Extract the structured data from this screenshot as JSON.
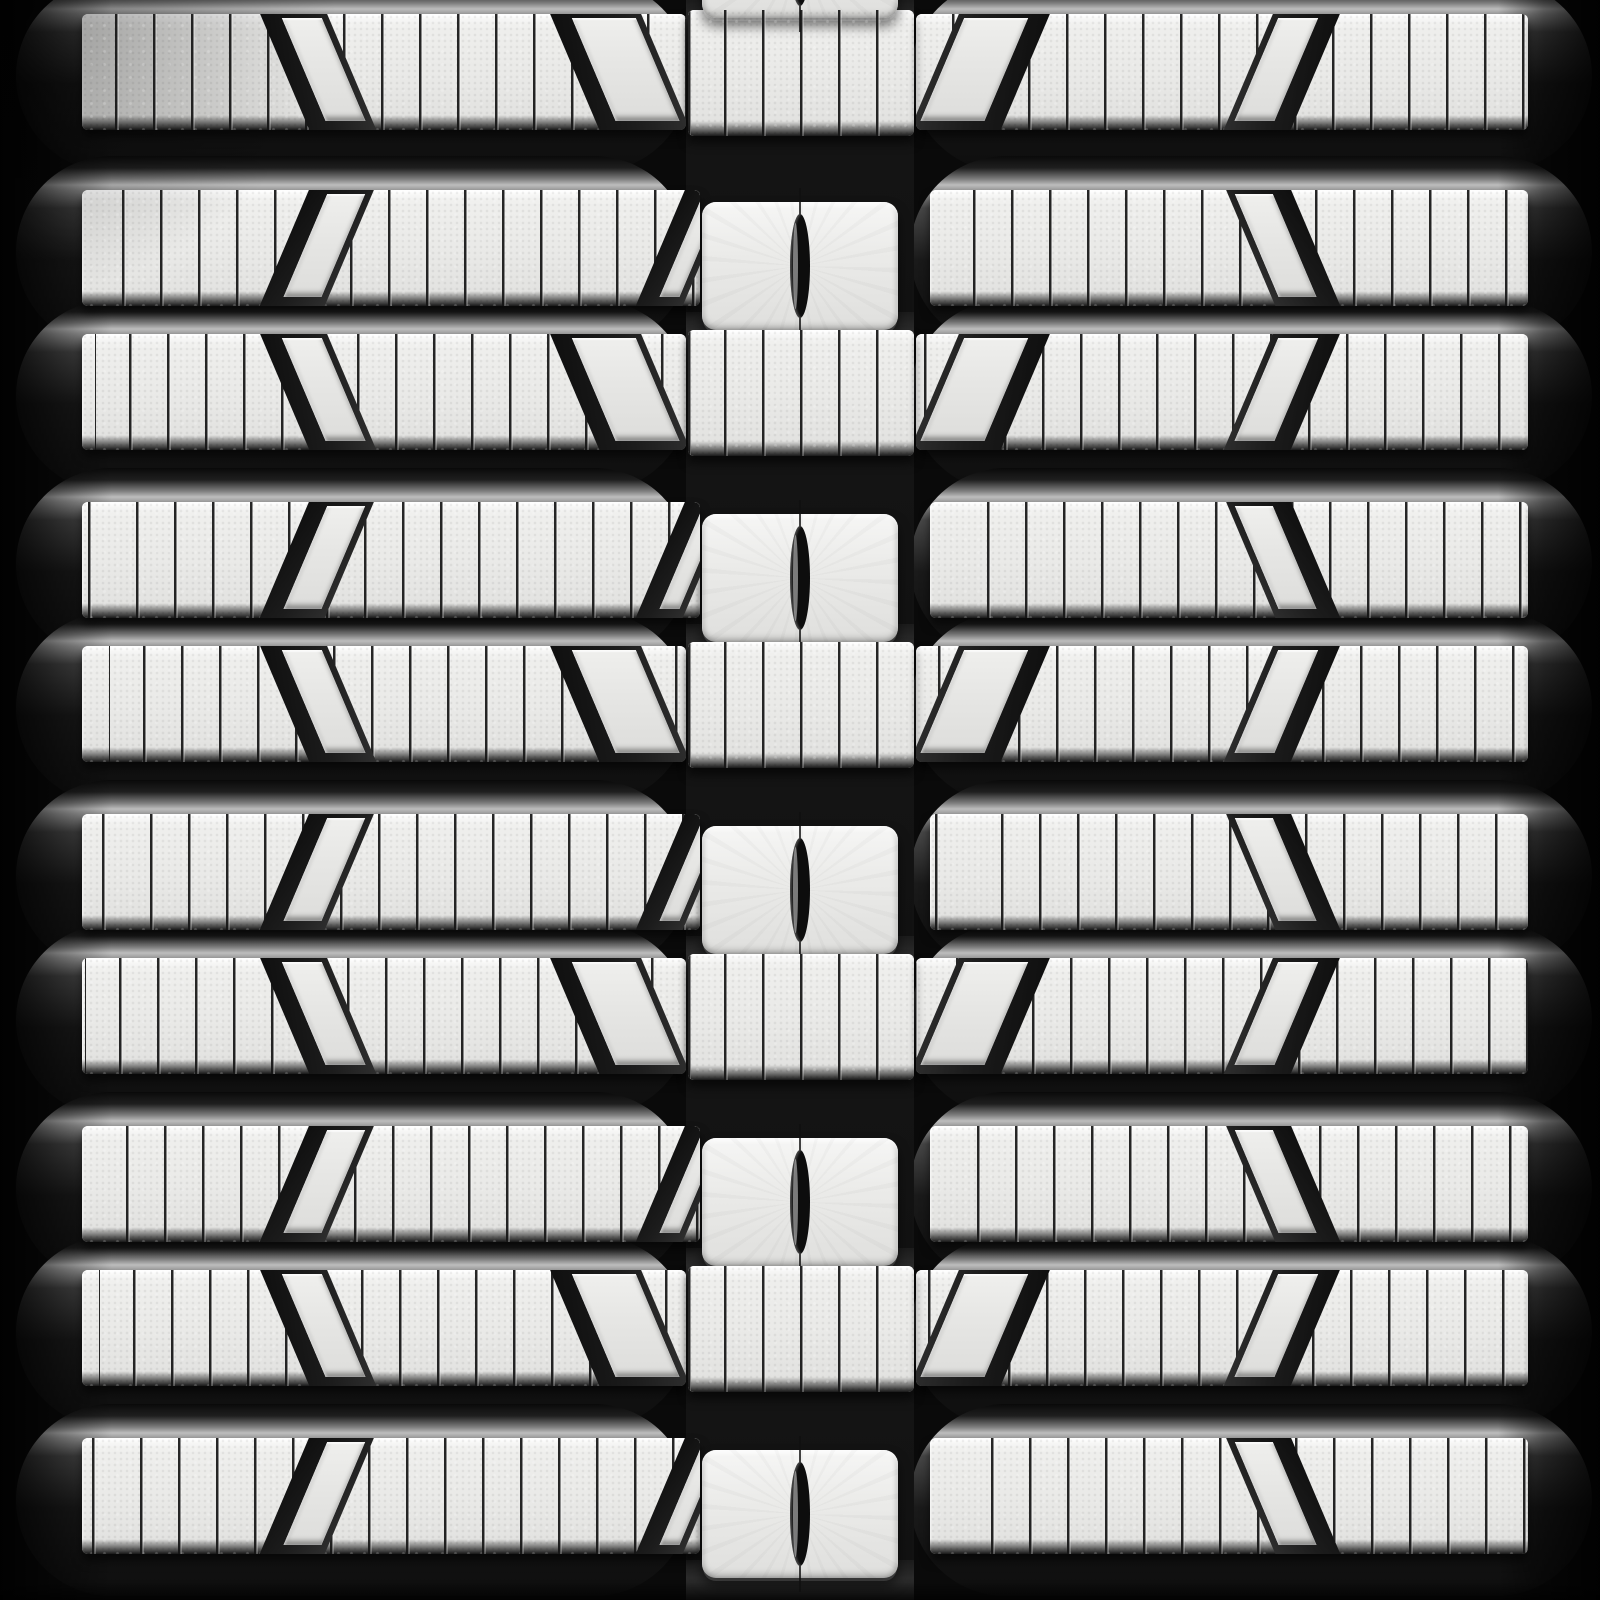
{
  "image": {
    "subject": "Rubber track tread pattern",
    "description": "Top-down close-up studio photograph of a compact-track-loader rubber track: horizontal metallic-gray siped tread bars in a mirrored multi-bar pattern, angled parallelogram cutouts, and a recessed center channel with drive blocks pierced by narrow lens-shaped slots.",
    "photo_style": "grayscale product photo",
    "visible_text": ""
  },
  "palette": {
    "background": "#0a0a0a",
    "ridge_highlight": "#bdbdbd",
    "tread_face": "#e9e9e7",
    "tread_face_bright": "#f8f8f7",
    "tread_face_shade": "#e0e0de",
    "sipe_line": "#141414",
    "recess_dark": "#1c1c1c",
    "slot_dark": "#0d0d0d"
  },
  "pattern": {
    "canvas": {
      "width": 1600,
      "height": 1600
    },
    "face_height": 116,
    "sipe_spacing": 38,
    "skew_degrees": 23,
    "rows": [
      {
        "variant": "A",
        "top": 14
      },
      {
        "variant": "B",
        "top": 190
      },
      {
        "variant": "A",
        "top": 334
      },
      {
        "variant": "B",
        "top": 502
      },
      {
        "variant": "A",
        "top": 646
      },
      {
        "variant": "B",
        "top": 814
      },
      {
        "variant": "A",
        "top": 958
      },
      {
        "variant": "B",
        "top": 1126
      },
      {
        "variant": "A",
        "top": 1270
      },
      {
        "variant": "B",
        "top": 1438
      }
    ],
    "row_templates": {
      "A": {
        "left_bar": {
          "x": 82,
          "w": 604
        },
        "right_bar": {
          "x": 916,
          "w": 612
        },
        "center_section": {
          "x": 688,
          "w": 226,
          "dy": -4,
          "h": 126
        },
        "cutouts": [
          {
            "side": "left",
            "x": 258,
            "w": 67,
            "skew": 23
          },
          {
            "side": "left",
            "x": 548,
            "w": 91,
            "skew": 23
          },
          {
            "side": "right",
            "x": 1275,
            "w": 67,
            "skew": -23
          },
          {
            "side": "right",
            "x": 961,
            "w": 91,
            "skew": -23
          }
        ]
      },
      "B": {
        "left_bar": {
          "x": 82,
          "w": 618
        },
        "right_bar": {
          "x": 930,
          "w": 598
        },
        "center_block": {
          "x": 702,
          "w": 196,
          "dy": 12,
          "h": 128,
          "slot_w": 20,
          "slot_h": 104
        },
        "cutouts": [
          {
            "side": "left",
            "x": 311,
            "w": 65,
            "skew": -23
          },
          {
            "side": "left",
            "x": 687,
            "w": 47,
            "skew": -23
          },
          {
            "side": "right",
            "x": 1224,
            "w": 65,
            "skew": 23
          }
        ]
      }
    },
    "extra_blocks": [
      {
        "top": -110
      }
    ],
    "bevel": {
      "left_x": 16,
      "left_w": 674,
      "right_x": 910,
      "right_w": 682,
      "dy": -34,
      "h": 192
    },
    "center_channel": {
      "x": 686,
      "w": 228
    },
    "counts": {
      "tread_rows": 10,
      "drive_blocks_visible": 6,
      "cutouts_per_A_row": 4,
      "cutouts_per_B_row": 3
    }
  }
}
